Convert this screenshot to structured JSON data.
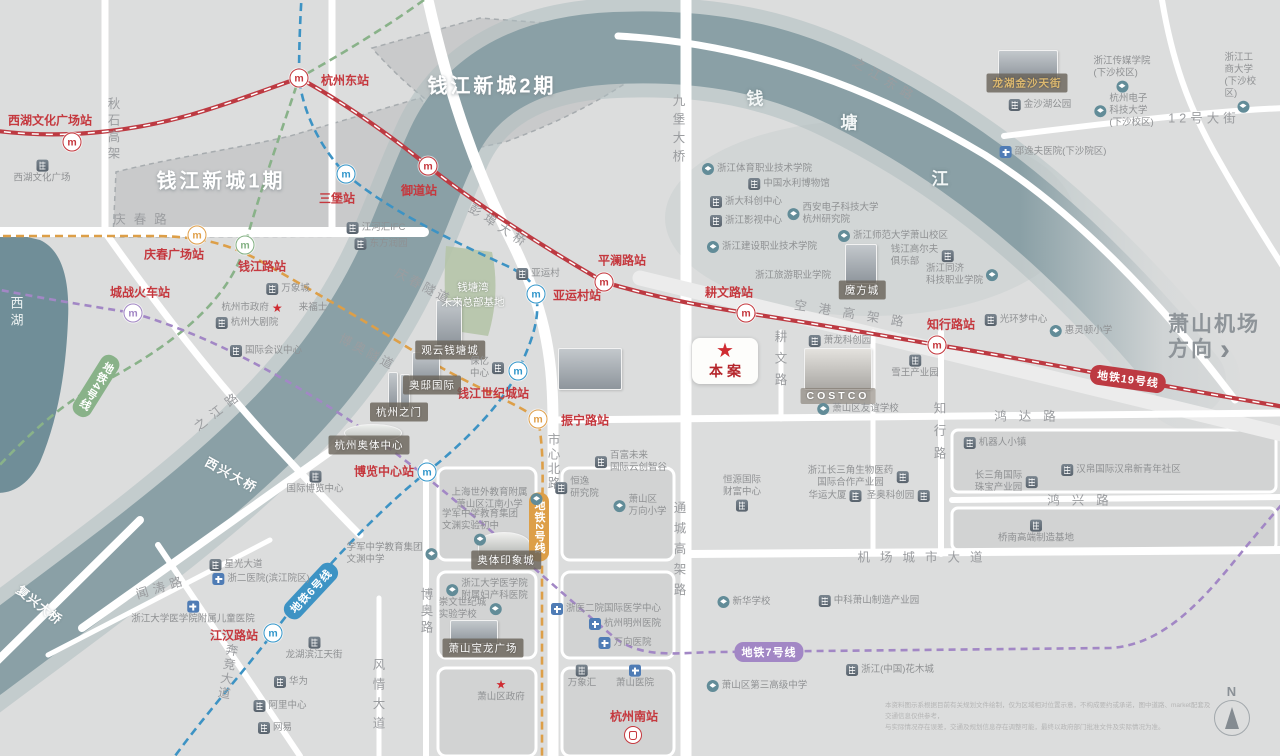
{
  "colors": {
    "red": "#c5383e",
    "orange": "#e0a04b",
    "green": "#83b183",
    "blue": "#3397cb",
    "purple": "#a287c5",
    "river": "#8aa0a6",
    "plaque_bg": "#6a645a",
    "gold": "#dcb86f"
  },
  "site": {
    "label": "本案"
  },
  "direction": {
    "line1": "萧山机场",
    "line2": "方向",
    "arrow": "›"
  },
  "compass": {
    "label": "N"
  },
  "disclaimer": {
    "text": "本资料图示系根据目前有关规划文件绘制，仅为区域相对位置示意，不构成要约或承诺，图中道路、market配套及交通信息仅供参考，\n与实际情况存在误差，交通及规划信息存在调整可能，最终以政府部门批准文件及实际情况为准。"
  },
  "area_labels": [
    {
      "text": "钱江新城1期",
      "x": 221,
      "y": 179,
      "cls": "area-big"
    },
    {
      "text": "钱江新城2期",
      "x": 492,
      "y": 84,
      "cls": "area-big"
    },
    {
      "text": "钱",
      "x": 755,
      "y": 97,
      "cls": "river-ch"
    },
    {
      "text": "塘",
      "x": 849,
      "y": 121,
      "cls": "river-ch"
    },
    {
      "text": "江",
      "x": 940,
      "y": 177,
      "cls": "river-ch"
    },
    {
      "text": "西湖",
      "x": 16,
      "y": 313,
      "cls": "lake"
    },
    {
      "text": "钱塘湾\n未来总部基地",
      "x": 473,
      "y": 295,
      "cls": "zonesub"
    }
  ],
  "road_labels": [
    {
      "text": "庆春路",
      "x": 144,
      "y": 218,
      "sp": 8
    },
    {
      "text": "秋石高架",
      "x": 113,
      "y": 130,
      "v": 1,
      "sp": 4
    },
    {
      "text": "之江路",
      "x": 218,
      "y": 409,
      "rot": -38,
      "sp": 7
    },
    {
      "text": "西兴大桥",
      "x": 232,
      "y": 474,
      "rot": 29,
      "sp": 2,
      "cls": "bridge"
    },
    {
      "text": "复兴大桥",
      "x": 40,
      "y": 604,
      "rot": 38,
      "sp": 1,
      "cls": "bridge"
    },
    {
      "text": "闻涛路",
      "x": 161,
      "y": 586,
      "rot": -17,
      "sp": 5
    },
    {
      "text": "奔竞大道",
      "x": 227,
      "y": 672,
      "v": 1,
      "rot": 10,
      "sp": 2
    },
    {
      "text": "博奥路",
      "x": 426,
      "y": 612,
      "v": 1,
      "sp": 4
    },
    {
      "text": "风情大道",
      "x": 378,
      "y": 697,
      "v": 1,
      "sp": 7
    },
    {
      "text": "市心北路",
      "x": 553,
      "y": 462,
      "v": 1,
      "sp": 2
    },
    {
      "text": "通城高架路",
      "x": 679,
      "y": 552,
      "v": 1,
      "sp": 8
    },
    {
      "text": "九堡大桥",
      "x": 678,
      "y": 131,
      "v": 1,
      "sp": 6
    },
    {
      "text": "彭埠大桥",
      "x": 500,
      "y": 225,
      "rot": 33,
      "sp": 5
    },
    {
      "text": "庆春隧道",
      "x": 424,
      "y": 285,
      "rot": 28,
      "sp": 3
    },
    {
      "text": "博奥隧道",
      "x": 368,
      "y": 351,
      "rot": 28,
      "sp": 3
    },
    {
      "text": "空港高架路",
      "x": 855,
      "y": 313,
      "rot": 9,
      "sp": 12
    },
    {
      "text": "鸿达路",
      "x": 1031,
      "y": 415,
      "sp": 12
    },
    {
      "text": "鸿兴路",
      "x": 1084,
      "y": 499,
      "sp": 12
    },
    {
      "text": "机场城市大道",
      "x": 925,
      "y": 556,
      "sp": 10
    },
    {
      "text": "知行路",
      "x": 939,
      "y": 435,
      "v": 1,
      "sp": 10
    },
    {
      "text": "耕文路",
      "x": 780,
      "y": 362,
      "v": 1,
      "sp": 9
    },
    {
      "text": "之江东路",
      "x": 886,
      "y": 79,
      "rot": 31,
      "sp": 6
    },
    {
      "text": "12号大街",
      "x": 1204,
      "y": 117,
      "sp": 4
    }
  ],
  "metro_badges": [
    {
      "text": "地铁19号线",
      "x": 1128,
      "y": 379,
      "color": "#bd3a42",
      "rot": 8
    },
    {
      "text": "地铁2号线",
      "x": 539,
      "y": 527,
      "color": "#dd9f48",
      "v": 1
    },
    {
      "text": "地铁4号线",
      "x": 96,
      "y": 386,
      "color": "#89b289",
      "v": 1,
      "rot": 32
    },
    {
      "text": "地铁6号线",
      "x": 311,
      "y": 591,
      "color": "#3d93c4",
      "rot": -47
    },
    {
      "text": "地铁7号线",
      "x": 769,
      "y": 652,
      "color": "#a287c5"
    }
  ],
  "stations": [
    {
      "name": "西湖文化广场站",
      "x": 72,
      "y": 142,
      "line": "red",
      "lx": 50,
      "ly": 120
    },
    {
      "name": "杭州东站",
      "x": 299,
      "y": 78,
      "line": "red",
      "lx": 345,
      "ly": 80
    },
    {
      "name": "御道站",
      "x": 428,
      "y": 166,
      "line": "red",
      "lx": 419,
      "ly": 190
    },
    {
      "name": "三堡站",
      "x": 346,
      "y": 174,
      "line": "blue",
      "lx": 337,
      "ly": 198
    },
    {
      "name": "庆春广场站",
      "x": 197,
      "y": 235,
      "line": "orange",
      "lx": 174,
      "ly": 254
    },
    {
      "name": "钱江路站",
      "x": 245,
      "y": 245,
      "line": "green",
      "lx": 262,
      "ly": 266
    },
    {
      "name": "城战火车站",
      "x": 133,
      "y": 313,
      "line": "purple",
      "lx": 140,
      "ly": 292
    },
    {
      "name": "平澜路站",
      "x": 604,
      "y": 282,
      "line": "red",
      "lx": 622,
      "ly": 260
    },
    {
      "name": "亚运村站",
      "x": 536,
      "y": 294,
      "line": "blue",
      "lx": 577,
      "ly": 295
    },
    {
      "name": "耕文路站",
      "x": 746,
      "y": 313,
      "line": "red",
      "lx": 729,
      "ly": 292
    },
    {
      "name": "知行路站",
      "x": 937,
      "y": 345,
      "line": "red",
      "lx": 951,
      "ly": 324
    },
    {
      "name": "钱江世纪城站",
      "x": 518,
      "y": 371,
      "line": "blue",
      "lx": 493,
      "ly": 393
    },
    {
      "name": "振宁路站",
      "x": 538,
      "y": 419,
      "line": "orange",
      "lx": 585,
      "ly": 420
    },
    {
      "name": "博览中心站",
      "x": 427,
      "y": 472,
      "line": "blue",
      "lx": 384,
      "ly": 471
    },
    {
      "name": "江汉路站",
      "x": 273,
      "y": 633,
      "line": "blue",
      "lx": 234,
      "ly": 635
    },
    {
      "name": "杭州南站",
      "x": 633,
      "y": 735,
      "line": "red",
      "lx": 634,
      "ly": 716,
      "type": "rail"
    }
  ],
  "plaques": [
    {
      "text": "观云钱塘城",
      "x": 450,
      "y": 350
    },
    {
      "text": "奥邸国际",
      "x": 432,
      "y": 385
    },
    {
      "text": "杭州之门",
      "x": 399,
      "y": 412
    },
    {
      "text": "杭州奥体中心",
      "x": 369,
      "y": 445
    },
    {
      "text": "奥体印象城",
      "x": 506,
      "y": 560
    },
    {
      "text": "萧山宝龙广场",
      "x": 483,
      "y": 648
    },
    {
      "text": "魔方城",
      "x": 862,
      "y": 290
    },
    {
      "text": "COSTCO",
      "x": 838,
      "y": 396,
      "cls": "costco"
    },
    {
      "text": "龙湖金沙天街",
      "x": 1027,
      "y": 83,
      "cls": "gold"
    }
  ],
  "pois": [
    {
      "text": "西湖文化广场",
      "x": 42,
      "y": 172,
      "k": "b",
      "s": "t"
    },
    {
      "text": "金沙湖公园",
      "x": 1040,
      "y": 105,
      "k": "b",
      "s": "l"
    },
    {
      "text": "浙江传媒学院\n(下沙校区)",
      "x": 1122,
      "y": 74,
      "k": "s",
      "s": "b"
    },
    {
      "text": "杭州电子\n科技大学\n(下沙校区)",
      "x": 1124,
      "y": 111,
      "k": "s",
      "s": "l",
      "al": "left"
    },
    {
      "text": "浙江工商大学\n(下沙校区)",
      "x": 1243,
      "y": 82,
      "k": "s",
      "s": "b"
    },
    {
      "text": "邵逸夫医院(下沙院区)",
      "x": 1053,
      "y": 152,
      "k": "h",
      "s": "l"
    },
    {
      "text": "浙江体育职业技术学院",
      "x": 757,
      "y": 169,
      "k": "s",
      "s": "l"
    },
    {
      "text": "中国水利博物馆",
      "x": 789,
      "y": 184,
      "k": "b",
      "s": "l"
    },
    {
      "text": "浙大科创中心",
      "x": 746,
      "y": 202,
      "k": "b",
      "s": "l"
    },
    {
      "text": "浙江影视中心",
      "x": 746,
      "y": 221,
      "k": "b",
      "s": "l"
    },
    {
      "text": "西安电子科技大学\n杭州研究院",
      "x": 833,
      "y": 214,
      "k": "s",
      "s": "l",
      "al": "left"
    },
    {
      "text": "浙江师范大学萧山校区",
      "x": 893,
      "y": 236,
      "k": "s",
      "s": "l"
    },
    {
      "text": "钱江高尔夫\n俱乐部",
      "x": 922,
      "y": 256,
      "k": "b",
      "s": "r",
      "al": "left"
    },
    {
      "text": "浙江同济\n科技职业学院",
      "x": 962,
      "y": 275,
      "k": "s",
      "s": "r",
      "al": "left"
    },
    {
      "text": "浙江建设职业技术学院",
      "x": 762,
      "y": 247,
      "k": "s",
      "s": "l"
    },
    {
      "text": "浙江旅游职业学院",
      "x": 793,
      "y": 276,
      "k": "none",
      "s": "l"
    },
    {
      "text": "萧龙科创园",
      "x": 840,
      "y": 341,
      "k": "b",
      "s": "l"
    },
    {
      "text": "雪王产业园",
      "x": 915,
      "y": 367,
      "k": "b",
      "s": "t"
    },
    {
      "text": "萧山区友谊学校",
      "x": 858,
      "y": 409,
      "k": "s",
      "s": "l"
    },
    {
      "text": "光环梦中心",
      "x": 1016,
      "y": 320,
      "k": "b",
      "s": "l"
    },
    {
      "text": "惠灵顿小学",
      "x": 1081,
      "y": 331,
      "k": "s",
      "s": "l"
    },
    {
      "text": "机器人小镇",
      "x": 995,
      "y": 443,
      "k": "b",
      "s": "l"
    },
    {
      "text": "长三角国际\n珠宝产业园",
      "x": 1006,
      "y": 482,
      "k": "b",
      "s": "r",
      "al": "left"
    },
    {
      "text": "汉帛国际汉帛新青年社区",
      "x": 1121,
      "y": 470,
      "k": "b",
      "s": "l"
    },
    {
      "text": "桥南高端制造基地",
      "x": 1036,
      "y": 532,
      "k": "b",
      "s": "t"
    },
    {
      "text": "恒源国际\n财富中心",
      "x": 742,
      "y": 493,
      "k": "b",
      "s": "b",
      "al": "left"
    },
    {
      "text": "浙江长三角生物医药\n国际合作产业园",
      "x": 858,
      "y": 477,
      "k": "b",
      "s": "r",
      "al": "center"
    },
    {
      "text": "华运大厦",
      "x": 835,
      "y": 496,
      "k": "b",
      "s": "r"
    },
    {
      "text": "圣奥科创园",
      "x": 898,
      "y": 496,
      "k": "b",
      "s": "r"
    },
    {
      "text": "百富未来\n国际云创智谷",
      "x": 631,
      "y": 462,
      "k": "b",
      "s": "l",
      "al": "left"
    },
    {
      "text": "恒逸\n研究院",
      "x": 577,
      "y": 488,
      "k": "b",
      "s": "l",
      "al": "left"
    },
    {
      "text": "萧山区\n万向小学",
      "x": 640,
      "y": 506,
      "k": "s",
      "s": "l",
      "al": "left"
    },
    {
      "text": "上海世外教育附属\n萧山区江南小学",
      "x": 497,
      "y": 499,
      "k": "s",
      "s": "r",
      "al": "center"
    },
    {
      "text": "学军中学教育集团\n文渊实验初中",
      "x": 480,
      "y": 527,
      "k": "s",
      "s": "b",
      "al": "left"
    },
    {
      "text": "学军中学教育集团\n文渊中学",
      "x": 392,
      "y": 554,
      "k": "s",
      "s": "r",
      "al": "left"
    },
    {
      "text": "浙江大学医学院\n附属妇产科医院",
      "x": 487,
      "y": 590,
      "k": "s",
      "s": "l",
      "al": "left"
    },
    {
      "text": "崇文世纪城\n实验学校",
      "x": 470,
      "y": 609,
      "k": "s",
      "s": "r",
      "al": "left"
    },
    {
      "text": "浙医二院国际医学中心",
      "x": 606,
      "y": 609,
      "k": "h",
      "s": "l"
    },
    {
      "text": "杭州明州医院",
      "x": 625,
      "y": 624,
      "k": "h",
      "s": "l"
    },
    {
      "text": "万向医院",
      "x": 625,
      "y": 643,
      "k": "h",
      "s": "l"
    },
    {
      "text": "万象汇",
      "x": 582,
      "y": 677,
      "k": "b",
      "s": "t"
    },
    {
      "text": "萧山医院",
      "x": 635,
      "y": 677,
      "k": "h",
      "s": "t"
    },
    {
      "text": "新华学校",
      "x": 744,
      "y": 602,
      "k": "s",
      "s": "l"
    },
    {
      "text": "中科萧山制造产业园",
      "x": 869,
      "y": 601,
      "k": "b",
      "s": "l"
    },
    {
      "text": "浙江(中国)花木城",
      "x": 890,
      "y": 670,
      "k": "b",
      "s": "l"
    },
    {
      "text": "萧山区第三高级中学",
      "x": 757,
      "y": 686,
      "k": "s",
      "s": "l"
    },
    {
      "text": "星光大道",
      "x": 236,
      "y": 565,
      "k": "b",
      "s": "l"
    },
    {
      "text": "浙二医院(滨江院区)",
      "x": 261,
      "y": 579,
      "k": "h",
      "s": "l"
    },
    {
      "text": "浙江大学医学院附属儿童医院",
      "x": 193,
      "y": 613,
      "k": "h",
      "s": "t"
    },
    {
      "text": "江河汇IFC",
      "x": 376,
      "y": 228,
      "k": "b",
      "s": "l"
    },
    {
      "text": "东方润园",
      "x": 381,
      "y": 244,
      "k": "b",
      "s": "l"
    },
    {
      "text": "万象城",
      "x": 288,
      "y": 289,
      "k": "b",
      "s": "l"
    },
    {
      "text": "杭州市政府",
      "x": 252,
      "y": 308,
      "k": "star",
      "s": "r"
    },
    {
      "text": "来福士",
      "x": 313,
      "y": 308,
      "k": "none",
      "s": "l"
    },
    {
      "text": "杭州大剧院",
      "x": 247,
      "y": 323,
      "k": "b",
      "s": "l"
    },
    {
      "text": "国际会议中心",
      "x": 266,
      "y": 351,
      "k": "b",
      "s": "l"
    },
    {
      "text": "国际博览中心",
      "x": 315,
      "y": 483,
      "k": "b",
      "s": "t"
    },
    {
      "text": "亚运村",
      "x": 538,
      "y": 274,
      "k": "b",
      "s": "l"
    },
    {
      "text": "保亿\n中心",
      "x": 487,
      "y": 368,
      "k": "b",
      "s": "r",
      "al": "left"
    },
    {
      "text": "龙湖滨江天街",
      "x": 314,
      "y": 649,
      "k": "b",
      "s": "t"
    },
    {
      "text": "华为",
      "x": 291,
      "y": 682,
      "k": "b",
      "s": "l"
    },
    {
      "text": "阿里中心",
      "x": 280,
      "y": 706,
      "k": "b",
      "s": "l"
    },
    {
      "text": "网易",
      "x": 275,
      "y": 728,
      "k": "b",
      "s": "l"
    },
    {
      "text": "萧山区政府",
      "x": 501,
      "y": 691,
      "k": "star",
      "s": "t"
    }
  ]
}
